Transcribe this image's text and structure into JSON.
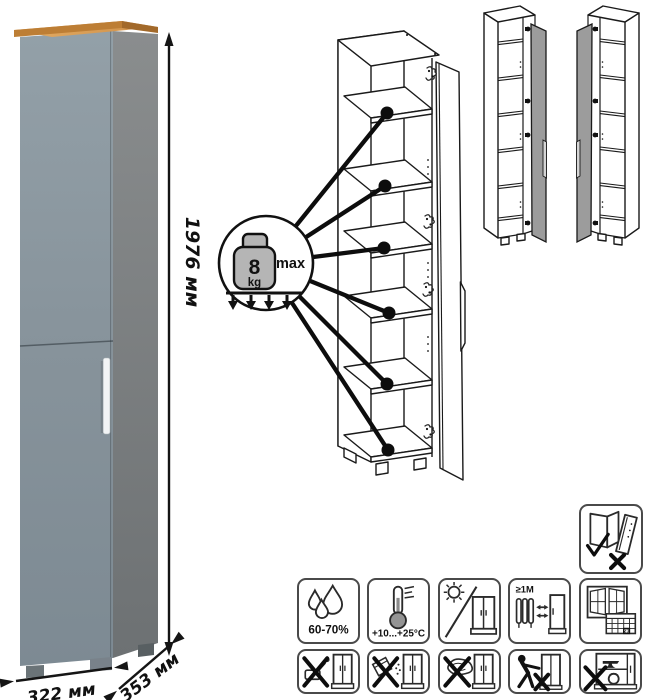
{
  "title": "Tall cabinet product sheet",
  "product": {
    "dimensions": {
      "height": "1976 мм",
      "width": "322 мм",
      "depth": "353 мм"
    },
    "colors": {
      "front_panel": "#87939b",
      "side_panel": "#7a7e80",
      "wood_top": "#c98a43",
      "handle": "#f4f6f7",
      "line_art": "#1a1a1a",
      "variant_door_fill": "#9c9c9c"
    }
  },
  "load_badge": {
    "value": "8",
    "unit": "kg",
    "qualifier": "max",
    "shelf_callouts": 6
  },
  "door_variants": {
    "count": 2,
    "options": [
      "door-hinged-right",
      "door-hinged-left"
    ]
  },
  "care_icons": {
    "door_mounting": {
      "name": "door-mounting-check-icon"
    },
    "humidity": {
      "name": "humidity-icon",
      "label": "60-70%"
    },
    "temperature": {
      "name": "temperature-icon",
      "label": "+10...+25°C"
    },
    "sunlight": {
      "name": "no-direct-sunlight-icon"
    },
    "heat_distance": {
      "name": "heat-distance-icon",
      "label": "≥1М"
    },
    "ventilation": {
      "name": "ventilation-calendar-icon",
      "calendar_day": "21"
    },
    "no_solvents": {
      "name": "no-solvents-icon"
    },
    "no_abrasives": {
      "name": "no-abrasive-powder-icon"
    },
    "no_wet_cleaning": {
      "name": "no-wet-sponge-icon"
    },
    "no_dragging": {
      "name": "no-dragging-icon"
    },
    "no_overload": {
      "name": "no-heavy-load-icon"
    }
  }
}
